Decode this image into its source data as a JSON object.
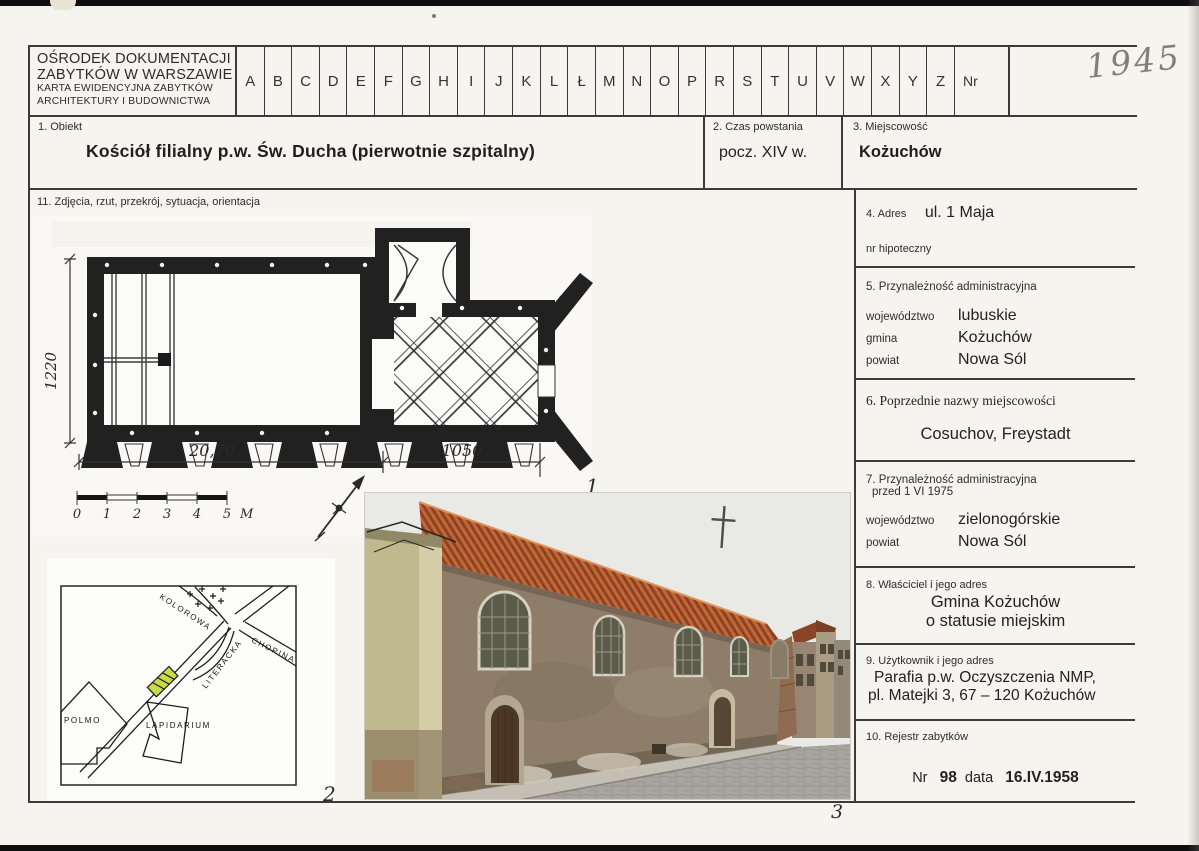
{
  "page": {
    "handwritten_number": "1945",
    "figures": {
      "plan": "1",
      "map": "2",
      "photo": "3"
    }
  },
  "header": {
    "org_lines": [
      "OŚRODEK DOKUMENTACJI",
      "ZABYTKÓW W WARSZAWIE",
      "KARTA EWIDENCYJNA ZABYTKÓW",
      "ARCHITEKTURY I BUDOWNICTWA"
    ],
    "letters": [
      "A",
      "B",
      "C",
      "D",
      "E",
      "F",
      "G",
      "H",
      "I",
      "J",
      "K",
      "L",
      "Ł",
      "M",
      "N",
      "O",
      "P",
      "R",
      "S",
      "T",
      "U",
      "V",
      "W",
      "X",
      "Y",
      "Z"
    ],
    "nr_label": "Nr"
  },
  "sections": {
    "obiekt": {
      "label": "1. Obiekt",
      "value": "Kościół filialny p.w. Św. Ducha (pierwotnie szpitalny)"
    },
    "czas": {
      "label": "2. Czas powstania",
      "value": "pocz. XIV w."
    },
    "miejscowosc": {
      "label": "3. Miejscowość",
      "value": "Kożuchów"
    },
    "adres": {
      "label": "4. Adres",
      "value": "ul. 1 Maja",
      "hipoteczny_label": "nr hipoteczny"
    },
    "admin": {
      "label": "5. Przynależność administracyjna",
      "wojewodztwo_label": "województwo",
      "wojewodztwo": "lubuskie",
      "gmina_label": "gmina",
      "gmina": "Kożuchów",
      "powiat_label": "powiat",
      "powiat": "Nowa Sól"
    },
    "poprzednie": {
      "label": "6. Poprzednie nazwy miejscowości",
      "value": "Cosuchov, Freystadt"
    },
    "admin_1975": {
      "label_line1": "7. Przynależność administracyjna",
      "label_line2": "przed 1 VI 1975",
      "wojewodztwo_label": "województwo",
      "wojewodztwo": "zielonogórskie",
      "powiat_label": "powiat",
      "powiat": "Nowa Sól"
    },
    "wlasciciel": {
      "label": "8. Właściciel i jego adres",
      "line1": "Gmina Kożuchów",
      "line2": "o statusie miejskim"
    },
    "uzytkownik": {
      "label": "9. Użytkownik i jego adres",
      "line1": "Parafia p.w. Oczyszczenia NMP,",
      "line2": "pl. Matejki 3, 67 – 120 Kożuchów"
    },
    "rejestr": {
      "label": "10. Rejestr zabytków",
      "nr_label": "Nr",
      "nr": "98",
      "data_label": "data",
      "data": "16.IV.1958"
    },
    "zdjecia": {
      "label": "11. Zdjęcia, rzut, przekrój, sytuacja, orientacja"
    }
  },
  "plan": {
    "dim_nave": "20,70",
    "dim_chancel": "1050",
    "dim_height": "1220",
    "scale_labels": [
      "0",
      "1",
      "2",
      "3",
      "4",
      "5"
    ],
    "scale_unit": "M"
  },
  "map": {
    "street_kolorowa": "KOLOROWA",
    "street_chopina": "CHOPINA",
    "street_literacka": "LITERACKA",
    "building_polmo": "POLMO",
    "building_lapidarium": "LAPIDARIUM"
  },
  "colors": {
    "map_highlight": "#c9d94a",
    "photo_roof": "#b3582e",
    "photo_wall": "#8d7d69",
    "photo_left_building": "#c0b98e",
    "photo_sky": "#e9e9e5",
    "photo_street": "#a8a5a0"
  }
}
